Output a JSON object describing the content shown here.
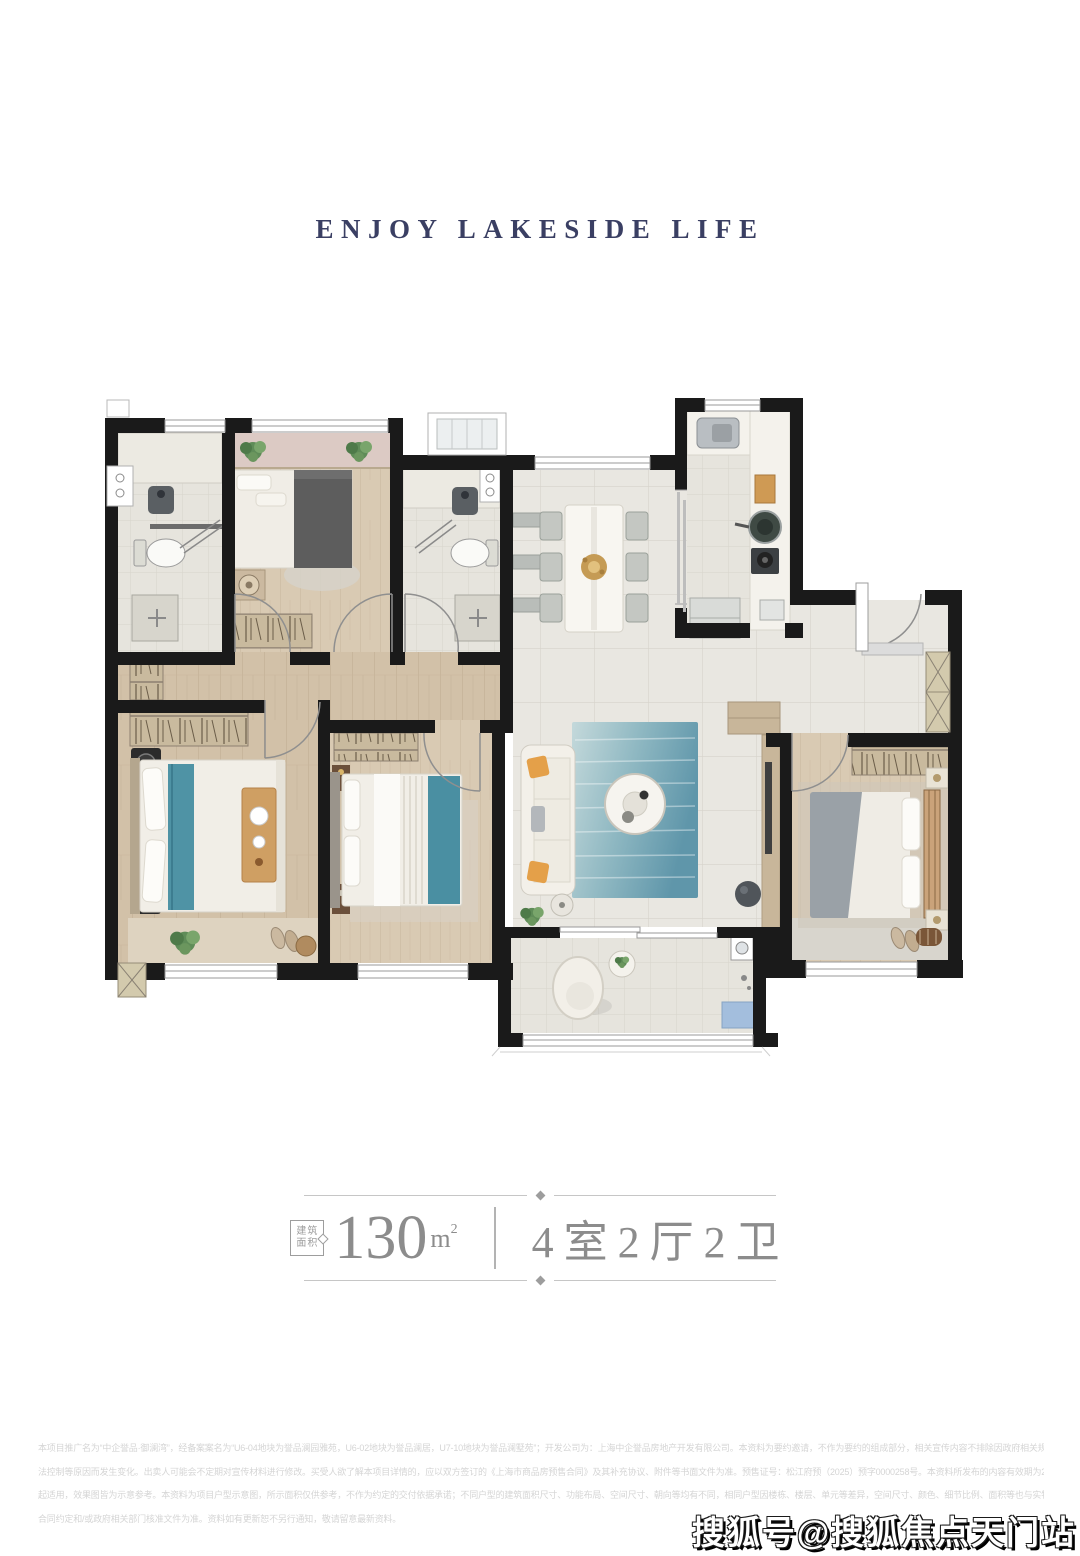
{
  "header": {
    "title": "ENJOY LAKESIDE LIFE",
    "color": "#3a3f63"
  },
  "floor_plan": {
    "type": "apartment-floor-plan",
    "rooms": [
      "bathroom-1",
      "bedroom-north",
      "bathroom-2",
      "dining-room",
      "kitchen",
      "entry-foyer",
      "hallway",
      "master-bedroom",
      "bedroom-2",
      "living-room",
      "bedroom-3",
      "balcony"
    ],
    "palette": {
      "wall": "#1a1a1a",
      "wood_floor": "#d2c1a8",
      "wood_floor_light": "#d9cab3",
      "tile": "#e9e7e1",
      "tile_small": "#e6e4dd",
      "accent_teal": "#4f93a5",
      "rug_blue": "#7fa9bb",
      "plant_green": "#5f8c58",
      "pillow_orange": "#e4a049",
      "balcony_strip_pink": "#dccac4"
    }
  },
  "spec": {
    "badge_top": "建筑",
    "badge_bottom": "面积",
    "area_value": "130",
    "area_unit": "m",
    "area_unit_sup": "2",
    "layout": "4室2厅2卫",
    "text_color": "#8c8c8c"
  },
  "disclaimer": {
    "lines": [
      "本项目推广名为“中企誉品·御澜湾”，经备案案名为“U6-04地块为誉品澜园雅苑，U6-02地块为誉品澜居，U7-10地块为誉品澜墅苑”；开发公司为：上海中企誉品房地产开发有限公司。本资料为要约邀请，不作为要约的组成部分，相关宣传内容不排除因政府相关规划、规定及出卖人无",
      "法控制等原因而发生变化。出卖人可能会不定期对宣传材料进行修改。买受人欲了解本项目详情的，应以双方签订的《上海市商品房预售合同》及其补充协议、附件等书面文件为准。预售证号：松江府预（2025）预字0000258号。本资料所发布的内容有效期为2023年8月",
      "起适用，效果图皆为示意参考。本资料为项目户型示意图，所示面积仅供参考，不作为约定的交付依据承诺；不同户型的建筑面积尺寸、功能布局、空间尺寸、朝向等均有不同，相同户型因楼栋、楼层、单元等差异，空间尺寸、颜色、细节比例、面积等也与实物有差异，最终以买卖",
      "合同约定和/或政府相关部门核准文件为准。资料如有更新恕不另行通知，敬请留意最新资料。"
    ]
  },
  "watermark": {
    "text": "搜狐号@搜狐焦点天门站"
  }
}
